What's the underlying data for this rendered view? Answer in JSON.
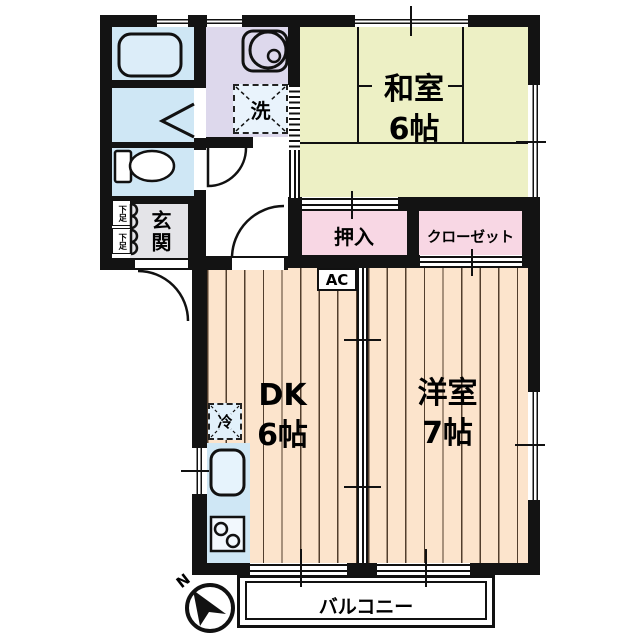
{
  "plan": {
    "type": "apartment-floor-plan",
    "rooms": {
      "washitsu": {
        "name": "和室",
        "size": "6帖"
      },
      "dk": {
        "name": "DK",
        "size": "6帖"
      },
      "youshitsu": {
        "name": "洋室",
        "size": "7帖"
      },
      "oshiire": {
        "name": "押入"
      },
      "closet": {
        "name": "クローゼット"
      },
      "genkan": {
        "name": "玄関"
      },
      "balcony": {
        "name": "バルコニー"
      }
    },
    "fixtures": {
      "washer": "洗",
      "fridge": "冷",
      "ac": "AC",
      "shoe_box_1": "下足",
      "shoe_box_2": "下足"
    },
    "compass": {
      "north": "N"
    },
    "colors": {
      "wall": "#131313",
      "tatami_room": "#edf0c5",
      "wood_floor": "#fce4cc",
      "closet_pink": "#f8d7e4",
      "wet_area_blue": "#cfe7f5",
      "washroom_lavender": "#ddd8ec",
      "genkan_gray": "#e4e4e8"
    }
  }
}
